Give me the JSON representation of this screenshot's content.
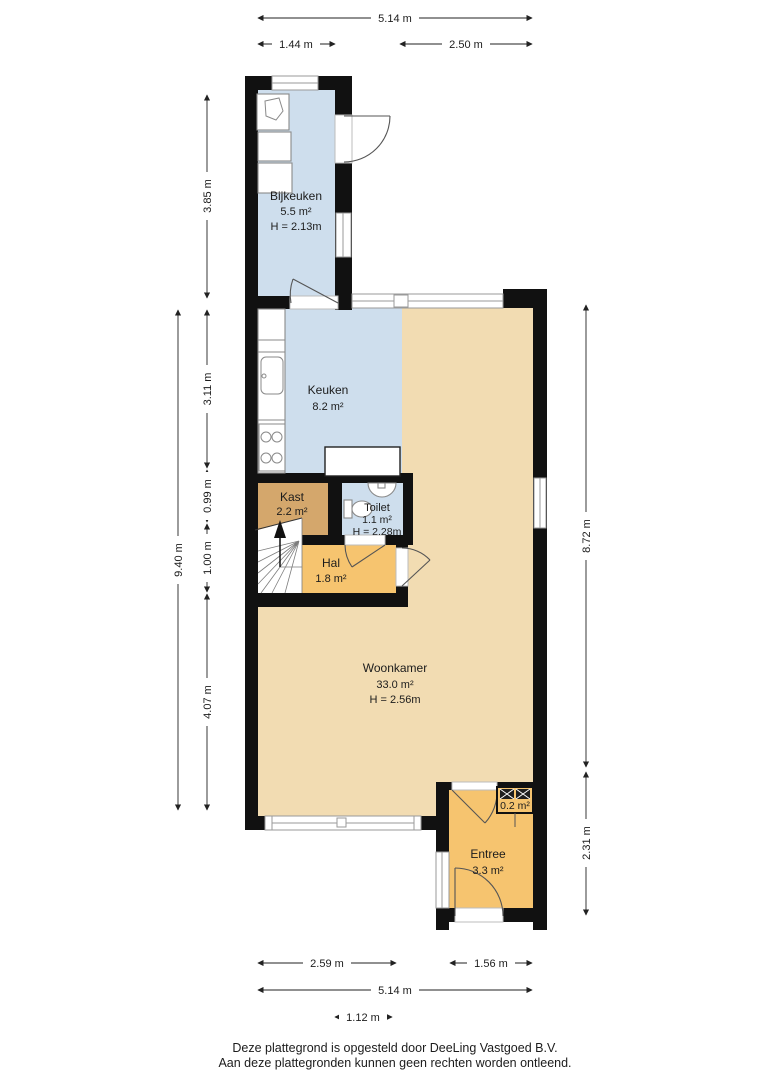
{
  "rooms": {
    "bijkeuken": {
      "name": "Bijkeuken",
      "area": "5.5 m²",
      "height": "H = 2.13m"
    },
    "keuken": {
      "name": "Keuken",
      "area": "8.2 m²"
    },
    "kast": {
      "name": "Kast",
      "area": "2.2 m²"
    },
    "toilet": {
      "name": "Toilet",
      "area": "1.1 m²",
      "height": "H = 2.28m"
    },
    "hal": {
      "name": "Hal",
      "area": "1.8 m²"
    },
    "woonkamer": {
      "name": "Woonkamer",
      "area": "33.0 m²",
      "height": "H = 2.56m"
    },
    "entree": {
      "name": "Entree",
      "area": "3.3 m²"
    },
    "meterkast": {
      "area": "0.2 m²"
    }
  },
  "dimensions": {
    "top_total": "5.14 m",
    "top_left": "1.44 m",
    "top_right": "2.50 m",
    "left_seg1": "3.85 m",
    "left_seg2": "3.11 m",
    "left_seg3": "0.99 m",
    "left_seg4": "1.00 m",
    "left_seg5": "4.07 m",
    "left_total": "9.40 m",
    "right_seg1": "8.72 m",
    "right_seg2": "2.31 m",
    "bottom_seg1": "2.59 m",
    "bottom_seg2": "1.56 m",
    "bottom_total": "5.14 m",
    "bottom_inner": "1.12 m"
  },
  "footer": {
    "line1": "Deze plattegrond is opgesteld door DeeLing Vastgoed B.V.",
    "line2": "Aan deze plattegronden kunnen geen rechten worden ontleend."
  },
  "colors": {
    "wall": "#111111",
    "room_blue": "#cedeed",
    "room_tan": "#f2dcb2",
    "room_orange": "#f6c46f",
    "room_brown": "#d4a76c"
  }
}
